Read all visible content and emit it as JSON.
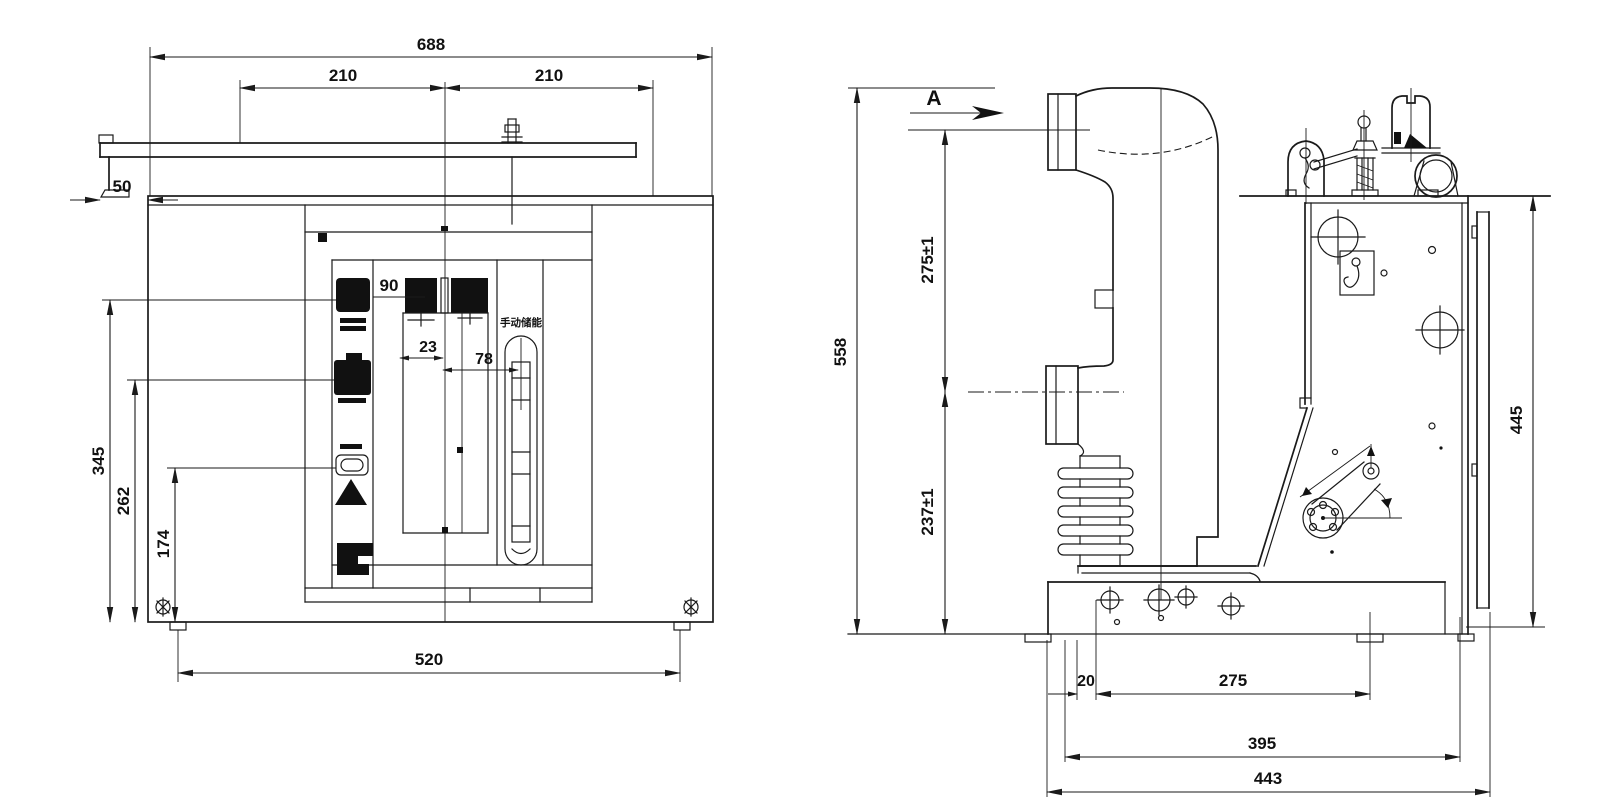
{
  "drawing": {
    "background_color": "#ffffff",
    "line_color": "#1a1a1a",
    "front_view": {
      "dim_overall_width": "688",
      "dim_pitch_left": "210",
      "dim_pitch_right": "210",
      "dim_rail_offset": "50",
      "dim_button_offset": "90",
      "dim_center_offset": "23",
      "dim_slot_offset": "78",
      "dim_height_1": "345",
      "dim_height_2": "262",
      "dim_height_3": "174",
      "dim_base_width": "520",
      "label_energy_slot": "手动储能"
    },
    "side_view": {
      "section_label": "A",
      "dim_overall_height": "558",
      "dim_upper_height": "275±1",
      "dim_lower_height": "237±1",
      "dim_frame_height": "445",
      "dim_base_offset": "20",
      "dim_hole_pitch": "275",
      "dim_base_width_inner": "395",
      "dim_base_width_outer": "443"
    }
  }
}
